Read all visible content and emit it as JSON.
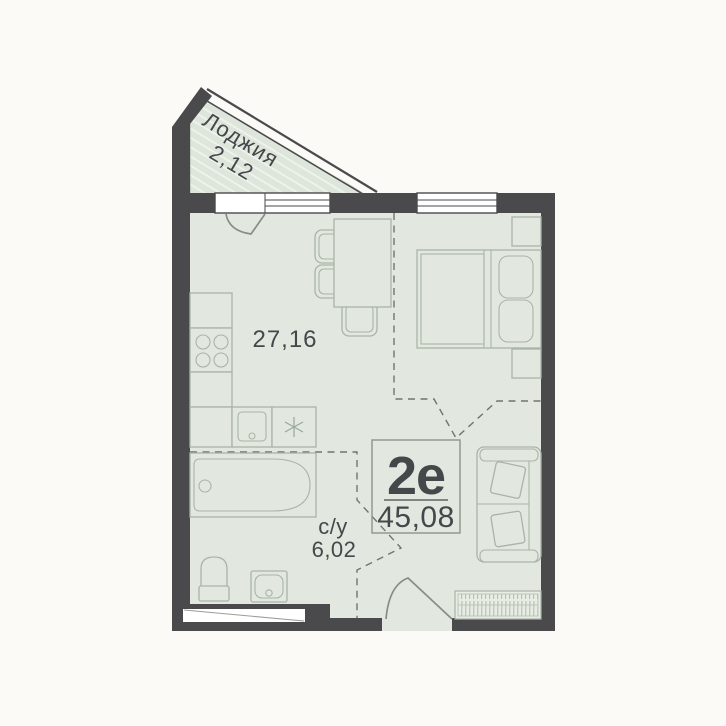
{
  "unit": {
    "type_label": "2е",
    "total_area": "45,08"
  },
  "rooms": {
    "loggia": {
      "label": "Лоджия",
      "area": "2,12"
    },
    "living_kitchen": {
      "area": "27,16"
    },
    "bathroom": {
      "label": "с/у",
      "area": "6,02"
    }
  },
  "colors": {
    "wall": "#4a4a4d",
    "floor": "#e2e8e0",
    "furniture_outline": "#a9b4a7",
    "dashed_zone_line": "#70756e",
    "text": "#45484b",
    "background": "#fbfaf7"
  }
}
